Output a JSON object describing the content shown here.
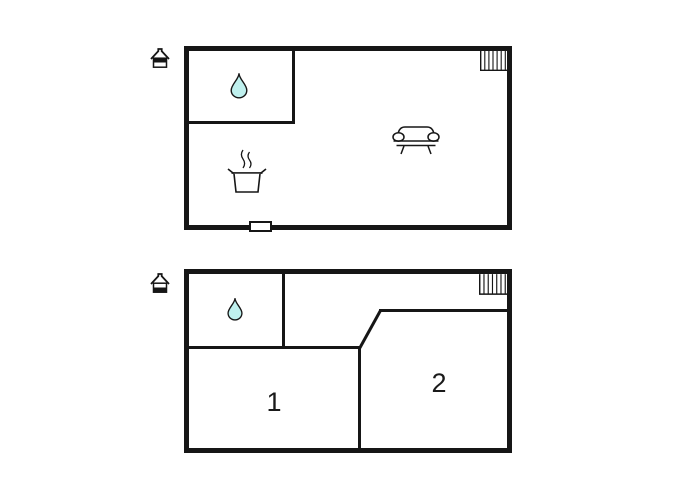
{
  "colors": {
    "wall": "#161616",
    "background": "#ffffff",
    "water_drop_fill": "#bff0ee"
  },
  "upper_plan": {
    "icons": {
      "level": "house-upper-level-icon",
      "water": "water-drop-icon",
      "stairs": "stairs-icon",
      "sofa": "sofa-icon",
      "pot": "cooking-pot-icon",
      "window": "window-marker"
    },
    "room_labels": []
  },
  "ground_plan": {
    "icons": {
      "level": "house-ground-level-icon",
      "water": "water-drop-icon",
      "stairs": "stairs-icon"
    },
    "room_labels": [
      "1",
      "2"
    ]
  }
}
